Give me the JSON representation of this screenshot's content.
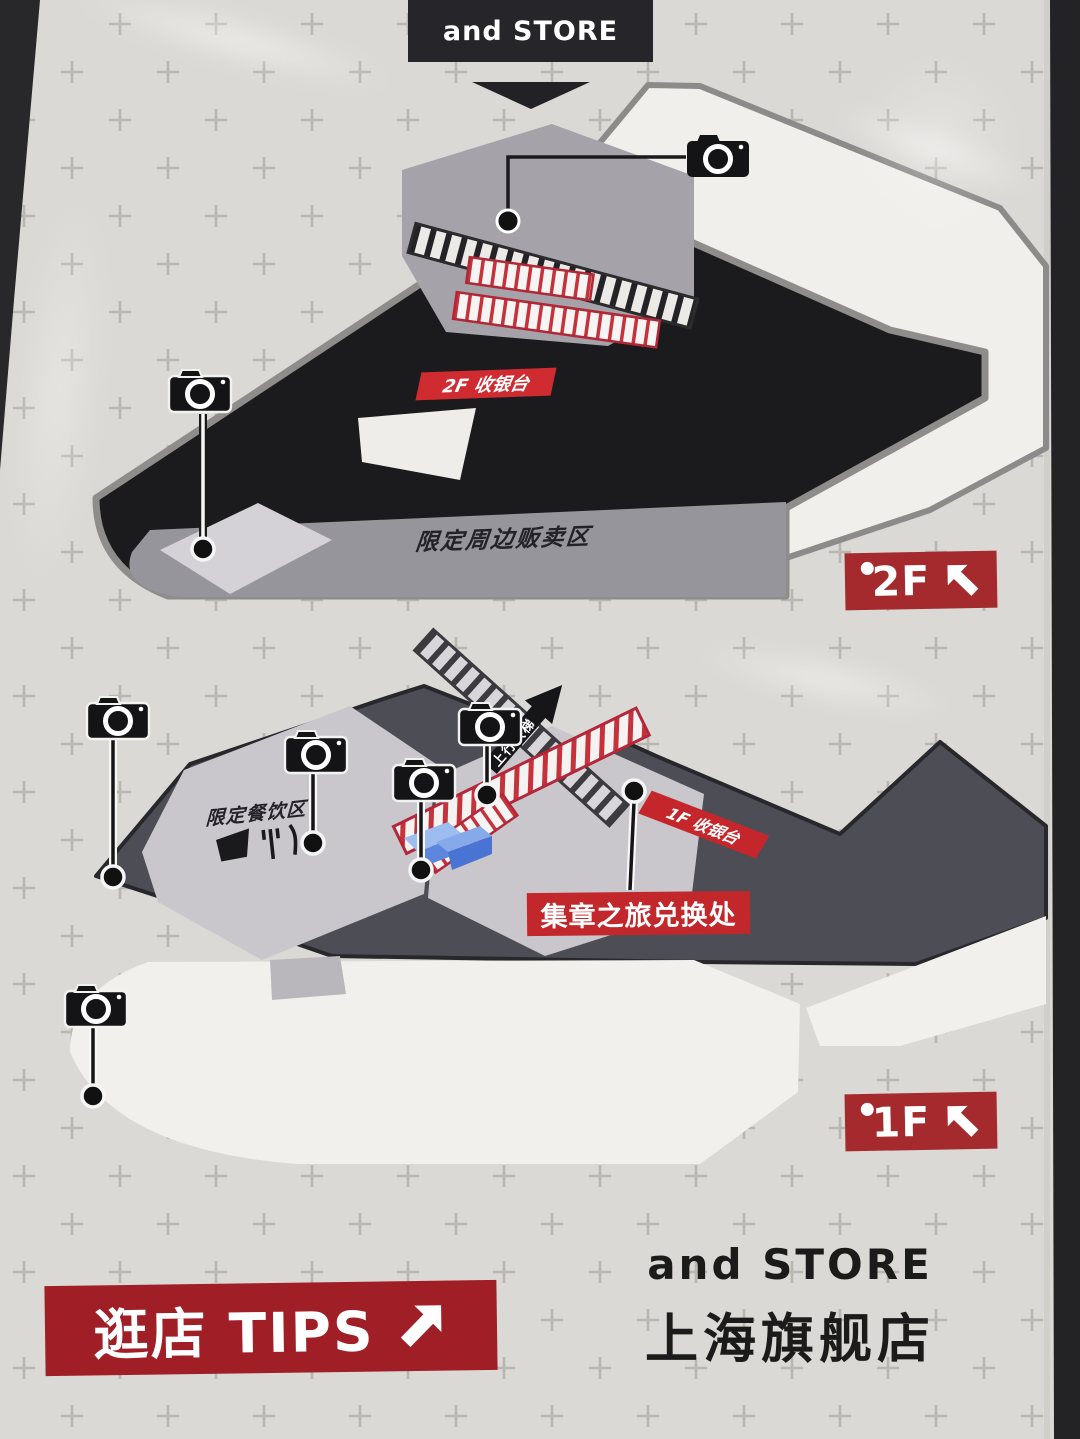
{
  "header": {
    "store_banner": "and STORE"
  },
  "floor2": {
    "badge": "2F",
    "cashier_banner": "2F 收银台",
    "merch_area_label": "限定周边贩卖区"
  },
  "floor1": {
    "badge": "1F",
    "cashier_banner": "1F 收银台",
    "dining_area_label": "限定餐饮区",
    "escalator_label": "上行扶梯",
    "stamp_exchange_banner": "集章之旅兑换处"
  },
  "footer": {
    "tips_banner": "逛店 TIPS",
    "brand_name": "and STORE",
    "store_name": "上海旗舰店"
  },
  "icons": {
    "camera": "camera-icon",
    "up_left_arrow": "arrow-up-left-icon",
    "up_right_arrow": "arrow-up-right-icon",
    "down_triangle": "triangle-down-icon",
    "cup": "cup-icon",
    "utensils": "utensils-icon"
  },
  "colors": {
    "banner_red": "#c0262b",
    "badge_red": "#a52a2e",
    "tips_red": "#a01f26",
    "map_black": "#1b1b1e",
    "map_dark_gray": "#4d4d56",
    "map_light_gray": "#c9c7cc"
  }
}
